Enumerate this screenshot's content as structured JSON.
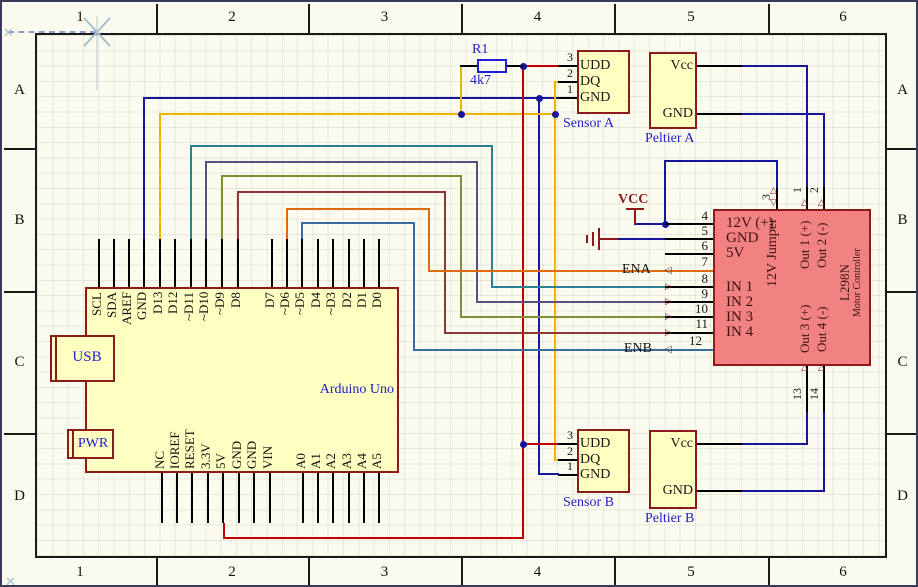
{
  "frame": {
    "columns": [
      "1",
      "2",
      "3",
      "4",
      "5",
      "6"
    ],
    "rows": [
      "A",
      "B",
      "C",
      "D"
    ]
  },
  "components": {
    "arduino": {
      "name": "Arduino Uno",
      "usb": "USB",
      "pwr": "PWR",
      "top_pins": [
        "SCL",
        "SDA",
        "AREF",
        "GND",
        "D13",
        "D12",
        "~D11",
        "~D10",
        "~D9",
        "D8",
        "D7",
        "~D6",
        "~D5",
        "D4",
        "~D3",
        "D2",
        "D1",
        "D0"
      ],
      "bottom_pins": [
        "NC",
        "IOREF",
        "RESET",
        "3.3V",
        "5V",
        "GND",
        "GND",
        "VIN",
        "A0",
        "A1",
        "A2",
        "A3",
        "A4",
        "A5"
      ]
    },
    "r1": {
      "ref": "R1",
      "value": "4k7"
    },
    "sensor_a": {
      "label": "Sensor A",
      "pin_numbers": [
        "3",
        "2",
        "1"
      ],
      "pin_names": [
        "UDD",
        "DQ",
        "GND"
      ]
    },
    "sensor_b": {
      "label": "Sensor B",
      "pin_numbers": [
        "3",
        "2",
        "1"
      ],
      "pin_names": [
        "UDD",
        "DQ",
        "GND"
      ]
    },
    "peltier_a": {
      "label": "Peltier A",
      "pin_names": [
        "Vcc",
        "GND"
      ]
    },
    "peltier_b": {
      "label": "Peltier B",
      "pin_names": [
        "Vcc",
        "GND"
      ]
    },
    "l298n": {
      "part": "L298N",
      "subtitle": "Motor Controller",
      "left_pin_numbers": [
        "4",
        "5",
        "6",
        "7",
        "8",
        "9",
        "10",
        "11",
        "12"
      ],
      "left_pin_names": [
        "12V (+)",
        "GND",
        "5V",
        "IN 1",
        "IN 2",
        "IN 3",
        "IN 4"
      ],
      "top_pin_numbers": [
        "3",
        "1",
        "2"
      ],
      "bottom_pin_numbers": [
        "13",
        "14"
      ],
      "vertical_labels": [
        "12V Jumper",
        "Out 1 (+)",
        "Out 2 (-)",
        "Out 3 (+)",
        "Out 4 (-)"
      ]
    }
  },
  "net_labels": {
    "vcc": "VCC",
    "ena": "ENA",
    "enb": "ENB"
  },
  "colors": {
    "wire_gnd": "#16169C",
    "wire_dq": "#EFB400",
    "wire_5v": "#C00000",
    "wire_d11": "#2E7F96",
    "wire_d10": "#5D4E80",
    "wire_d9": "#7E9032",
    "wire_d8": "#8E3535",
    "wire_d6": "#E06A10",
    "wire_d5": "#3A6B9E",
    "component_fill": "#FFFFC2",
    "component_border": "#8B1A1A",
    "driver_fill": "#F28181",
    "label_blue": "#2121C8",
    "symbol_red": "#8B1A1A"
  }
}
